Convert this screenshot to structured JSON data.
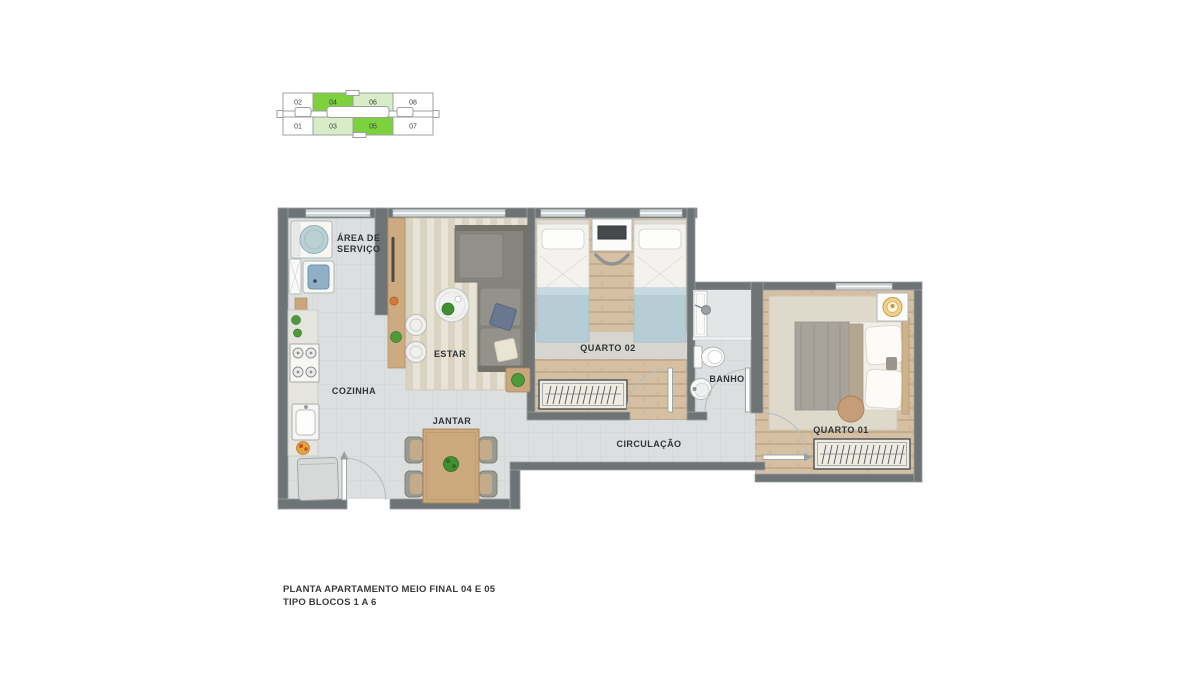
{
  "key_plan": {
    "top_row": [
      {
        "label": "02",
        "color": "#FFFFFF"
      },
      {
        "label": "04",
        "color": "#7CD13C"
      },
      {
        "label": "06",
        "color": "#D8ECC8"
      },
      {
        "label": "08",
        "color": "#FFFFFF"
      }
    ],
    "bottom_row": [
      {
        "label": "01",
        "color": "#FFFFFF"
      },
      {
        "label": "03",
        "color": "#D8ECC8"
      },
      {
        "label": "05",
        "color": "#7CD13C"
      },
      {
        "label": "07",
        "color": "#FFFFFF"
      }
    ],
    "outline_color": "#9BA29E"
  },
  "floor_plan": {
    "rooms": {
      "area_de_servico": {
        "line1": "ÁREA DE",
        "line2": "SERVIÇO"
      },
      "cozinha": {
        "label": "COZINHA"
      },
      "estar": {
        "label": "ESTAR"
      },
      "jantar": {
        "label": "JANTAR"
      },
      "quarto_02": {
        "label": "QUARTO 02"
      },
      "banho": {
        "label": "BANHO"
      },
      "circulacao": {
        "label": "CIRCULAÇÃO"
      },
      "quarto_01": {
        "label": "QUARTO 01"
      }
    },
    "palette": {
      "wall": "#6E7476",
      "tile_floor": "#DCDFE0",
      "wood_floor": "#D6C0A4",
      "rug_stripe_a": "#E8E3D7",
      "rug_stripe_b": "#DAD3C2",
      "bedroom_rug": "#D6D5CF",
      "blanket_blue": "#B6CDD6",
      "sofa_gray": "#85857D",
      "furniture_wood": "#C9A77C",
      "plant_green": "#4C9A39",
      "window": "#CDD2D3",
      "label_color": "#2F3437"
    }
  },
  "caption": {
    "line1": "PLANTA APARTAMENTO MEIO  FINAL 04 E 05",
    "line2": "TIPO BLOCOS 1 A 6"
  }
}
